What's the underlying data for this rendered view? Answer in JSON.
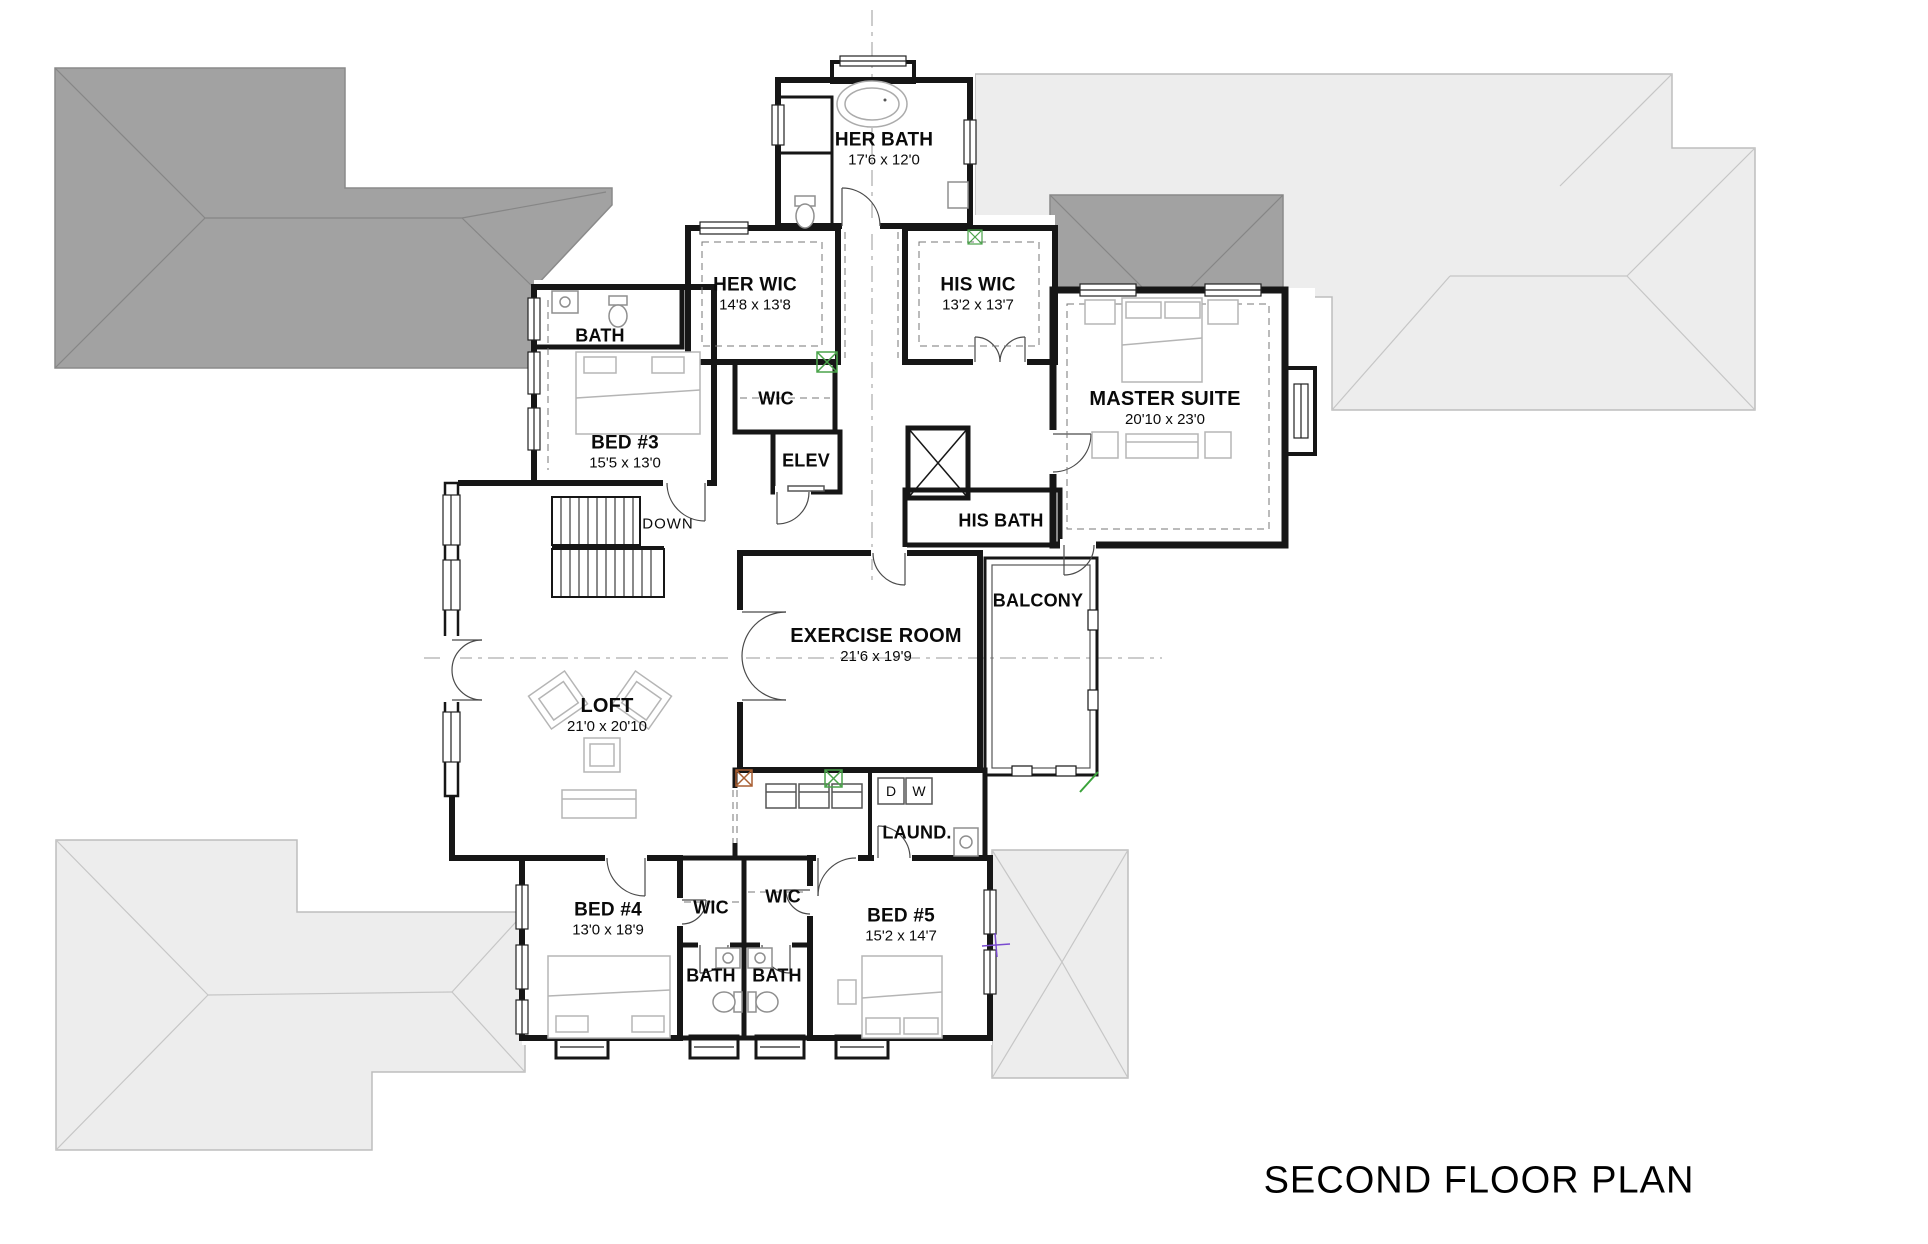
{
  "title": "SECOND FLOOR PLAN",
  "rooms": {
    "her_bath": {
      "name": "HER BATH",
      "dims": "17'6 x 12'0"
    },
    "her_wic": {
      "name": "HER WIC",
      "dims": "14'8 x 13'8"
    },
    "his_wic": {
      "name": "HIS WIC",
      "dims": "13'2 x 13'7"
    },
    "bath_bed3": {
      "name": "BATH"
    },
    "bed3": {
      "name": "BED #3",
      "dims": "15'5 x 13'0"
    },
    "wic_center": {
      "name": "WIC"
    },
    "elev": {
      "name": "ELEV"
    },
    "master_suite": {
      "name": "MASTER SUITE",
      "dims": "20'10 x 23'0"
    },
    "his_bath": {
      "name": "HIS BATH"
    },
    "exercise_room": {
      "name": "EXERCISE ROOM",
      "dims": "21'6 x 19'9"
    },
    "balcony": {
      "name": "BALCONY"
    },
    "loft": {
      "name": "LOFT",
      "dims": "21'0 x 20'10"
    },
    "laundry": {
      "name": "LAUND."
    },
    "bed4": {
      "name": "BED #4",
      "dims": "13'0 x 18'9"
    },
    "wic_bed4": {
      "name": "WIC"
    },
    "wic_bed5": {
      "name": "WIC"
    },
    "bath_bed4": {
      "name": "BATH"
    },
    "bath_bed5": {
      "name": "BATH"
    },
    "bed5": {
      "name": "BED #5",
      "dims": "15'2 x 14'7"
    }
  },
  "annotations": {
    "stairs_direction": "DOWN",
    "dryer": "D",
    "washer": "W"
  },
  "colors": {
    "wall": "#161616",
    "roof_dark": "#a2a2a2",
    "roof_light": "#ededed",
    "marker_green": "#4aa34a",
    "marker_red": "#a85f32",
    "marker_purple": "#7a4bd0"
  }
}
